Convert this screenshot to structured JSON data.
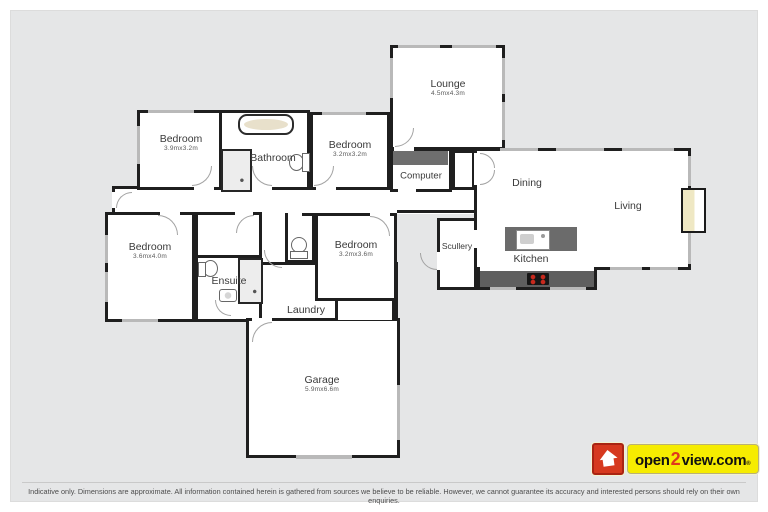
{
  "page": {
    "background_color": "#e5e6e7",
    "frame_color": "#ffffff"
  },
  "rooms": {
    "bedroom_top_left": {
      "label": "Bedroom",
      "dims": "3.9mx3.2m"
    },
    "bathroom": {
      "label": "Bathroom"
    },
    "bedroom_top_mid": {
      "label": "Bedroom",
      "dims": "3.2mx3.2m"
    },
    "lounge": {
      "label": "Lounge",
      "dims": "4.5mx4.3m"
    },
    "computer": {
      "label": "Computer"
    },
    "dining": {
      "label": "Dining"
    },
    "living": {
      "label": "Living"
    },
    "kitchen": {
      "label": "Kitchen"
    },
    "scullery": {
      "label": "Scullery"
    },
    "bedroom_left": {
      "label": "Bedroom",
      "dims": "3.6mx4.0m"
    },
    "ensuite": {
      "label": "Ensuite"
    },
    "bedroom_mid": {
      "label": "Bedroom",
      "dims": "3.2mx3.6m"
    },
    "laundry": {
      "label": "Laundry"
    },
    "garage": {
      "label": "Garage",
      "dims": "5.9mx6.6m"
    }
  },
  "footer": {
    "disclaimer": "Indicative only. Dimensions are approximate. All information contained herein is gathered from sources we believe to be reliable. However, we cannot guarantee its accuracy and interested persons should rely on their own enquiries."
  },
  "logo": {
    "prefix": "open",
    "two": "2",
    "suffix": "view.com",
    "registered": "®",
    "yellow": "#f6ec00",
    "red": "#d6391f"
  }
}
